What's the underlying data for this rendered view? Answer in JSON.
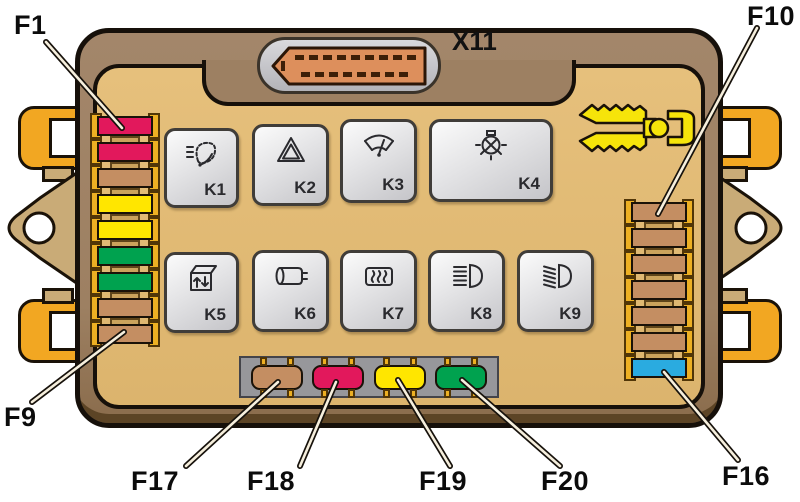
{
  "diagram": {
    "connector": {
      "label": "X11",
      "pins_top": 9,
      "pins_bottom": 8
    },
    "labels": {
      "f1": "F1",
      "f9": "F9",
      "f10": "F10",
      "f16": "F16",
      "f17": "F17",
      "f18": "F18",
      "f19": "F19",
      "f20": "F20"
    },
    "relays": [
      {
        "label": "K1",
        "icon": "headlight-washer-icon"
      },
      {
        "label": "K2",
        "icon": "hazard-warning-icon"
      },
      {
        "label": "K3",
        "icon": "windshield-wiper-icon"
      },
      {
        "label": "K4",
        "icon": "bulb-check-icon"
      },
      {
        "label": "K5",
        "icon": "power-window-icon"
      },
      {
        "label": "K6",
        "icon": "horn-icon"
      },
      {
        "label": "K7",
        "icon": "heated-rear-window-icon"
      },
      {
        "label": "K8",
        "icon": "high-beam-icon"
      },
      {
        "label": "K9",
        "icon": "low-beam-icon"
      }
    ],
    "fuse_columns": {
      "left": [
        "crimson",
        "crimson",
        "tan",
        "yellow",
        "yellow",
        "green",
        "green",
        "tan",
        "tan"
      ],
      "right": [
        "tan",
        "tan",
        "tan",
        "tan",
        "tan",
        "tan",
        "blue"
      ],
      "bottom": [
        "tan",
        "crimson",
        "yellow",
        "green"
      ]
    },
    "colors": {
      "crimson": "#e2185c",
      "tan": "#c48e62",
      "yellow": "#ffe600",
      "green": "#00a24f",
      "blue": "#2aabe0",
      "holder_yellow": "#edb023",
      "panel_tan": "#e2bb74",
      "band_brown": "#9d8062",
      "clip_orange": "#f2a722",
      "strip_gray": "#97979b"
    }
  }
}
